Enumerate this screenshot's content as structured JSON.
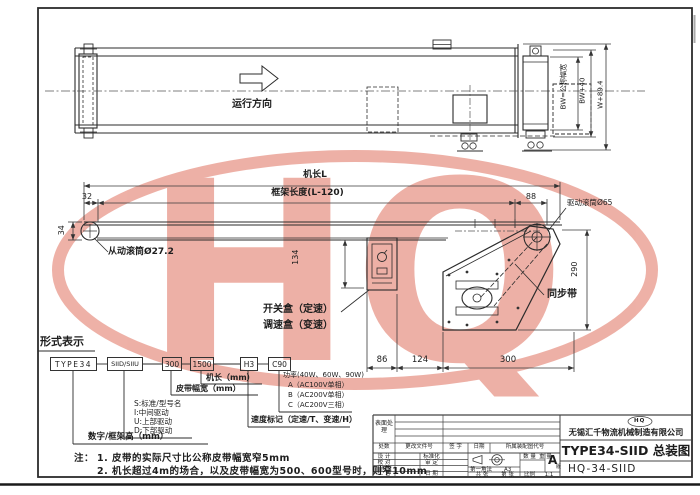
{
  "watermark": {
    "text": "HQ",
    "color": "#dd6450"
  },
  "top_view": {
    "direction_label": "运行方向",
    "dim_nominal_width": "BW=公称幅宽",
    "dim_bw_plus_40": "BW+40",
    "dim_w_overall": "W+89.4"
  },
  "side_view": {
    "dim_machine_length": "机长L",
    "dim_frame_length": "框架长度(L-120)",
    "dim_left_offset": "32",
    "dim_frame_height": "34",
    "dim_drive_offset": "88",
    "driven_roller_label": "从动滚筒Ø27.2",
    "drive_roller_label": "驱动滚筒Ø65",
    "dim_drive_height": "290",
    "sync_belt_label": "同步带",
    "dim_box_height": "134",
    "switch_box_label": "开关盒（定速）",
    "speed_box_label": "调速盒（变速）",
    "dim_a": "86",
    "dim_b": "124",
    "dim_c": "300"
  },
  "type_code": {
    "heading": "形式表示",
    "boxes": [
      "TYPE34",
      "SIID/SIIU",
      "300",
      "1500",
      "H3",
      "C90"
    ],
    "machine_length_label": "机长（mm）",
    "belt_width_label": "皮带幅宽（mm）",
    "drive_type_lines": [
      "S:标准/型号名",
      "I:中间驱动",
      "U:上部驱动",
      "D:下部驱动"
    ],
    "frame_height_label": "数字/框架高（mm）",
    "power_lines": [
      "功率(40W、60W、90W)",
      "A（AC100V单相）",
      "B（AC200V单相）",
      "C（AC200V三相）"
    ],
    "speed_mark_label": "速度标记（定速/T、变速/H）"
  },
  "notes": {
    "prefix": "注：",
    "line1": "1. 皮带的实际尺寸比公称皮带幅宽窄5mm",
    "line2": "2. 机长超过4m的场合，以及皮带幅宽为500、600型号时，则窄10mm"
  },
  "title_block": {
    "company": "无锡汇千物流机械制造有限公司",
    "logo_text": "HQ",
    "drawing_title": "TYPE34-SIID 总装图",
    "drawing_number": "HQ-34-SIID",
    "surface_treatment": "表面处理",
    "col_headers": [
      "处数",
      "更改文件号",
      "签 字",
      "日期"
    ],
    "assembly_code_label": "所属装配图代号",
    "row_labels": [
      "设 计",
      "校 对",
      "审 核",
      "工 艺"
    ],
    "mid_labels": [
      "标准化",
      "审 定",
      "日 期"
    ],
    "projection_label": "第一角法",
    "paper_size": "A3",
    "qty_label": "数 量",
    "weight_label": "重 量",
    "revision": "A",
    "revision_suffix": "版",
    "sheets_label": "共  张",
    "page_label": "第  张",
    "scale_label": "比例",
    "scale_value": "1:1"
  }
}
